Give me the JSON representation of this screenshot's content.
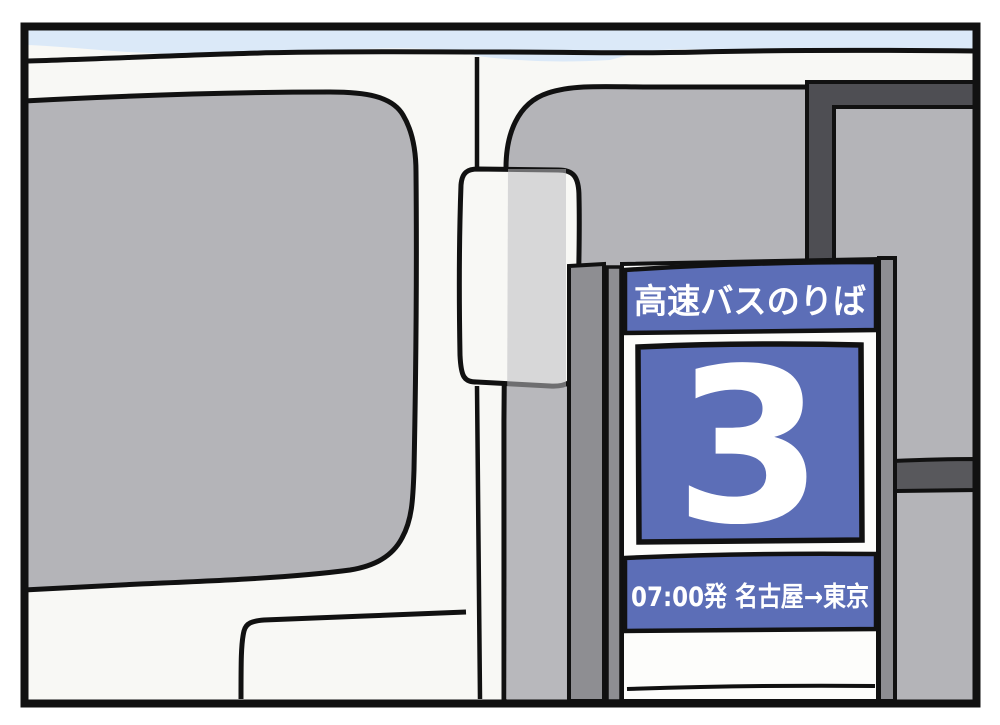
{
  "panel": {
    "sign": {
      "title": "高速バスのりば",
      "bay_number": "3",
      "departure": "07:00発 名古屋→東京"
    },
    "colors": {
      "outline": "#111111",
      "bus_body": "#f8f8f5",
      "sky": "#dbe9f8",
      "window_gray": "#b4b4b8",
      "pillar_gray": "#bcbcc0",
      "post_gray": "#8e8e92",
      "beam_dark": "#4e4e53",
      "rail_dark": "#58585c",
      "sign_blue": "#5c6eb7",
      "sign_board_white": "#fdfdfb",
      "sign_text_white": "#ffffff"
    }
  }
}
